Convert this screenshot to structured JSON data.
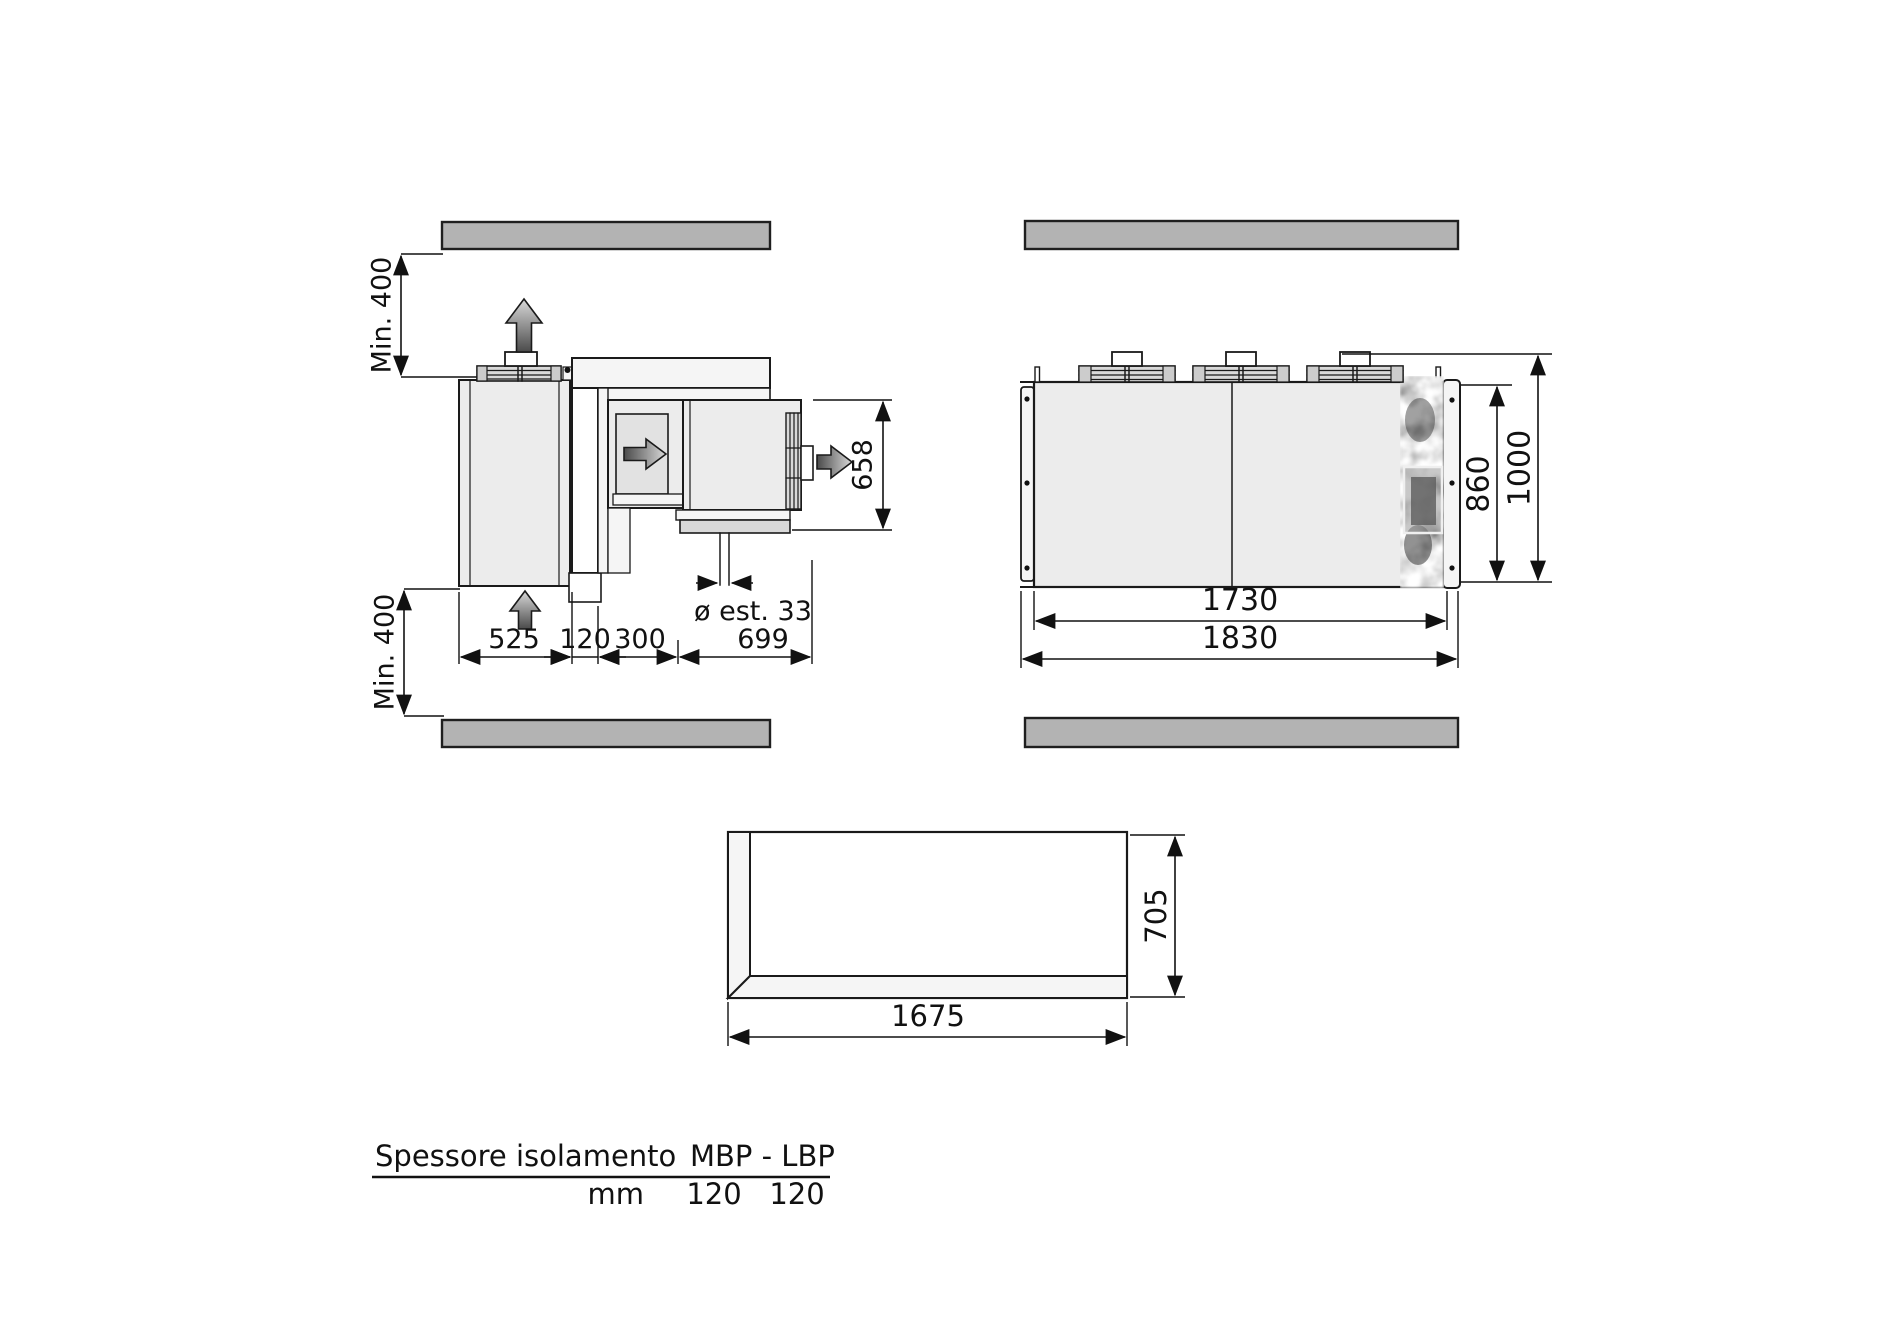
{
  "colors": {
    "wall_bar_fill": "#b3b3b3",
    "wall_bar_stroke": "#1f1f1f",
    "line": "#1a1a1a",
    "panel_fill": "#ececec"
  },
  "side_view": {
    "clearance_top_label": "Min. 400",
    "clearance_bottom_label": "Min. 400",
    "dims": {
      "evaporator_depth": "525",
      "wall_thickness": "120",
      "duct_depth": "300",
      "condenser_depth": "699",
      "unit_height": "658",
      "drain_diameter": "ø est. 33"
    }
  },
  "plan_view": {
    "dims": {
      "inner_width": "1730",
      "outer_width": "1830",
      "body_depth": "860",
      "overall_depth": "1000"
    }
  },
  "opening_view": {
    "dims": {
      "width": "1675",
      "height": "705"
    }
  },
  "spec_table": {
    "header_left": "Spessore isolamento",
    "header_right": "MBP - LBP",
    "unit_label": "mm",
    "mbp_value": "120",
    "lbp_value": "120"
  }
}
